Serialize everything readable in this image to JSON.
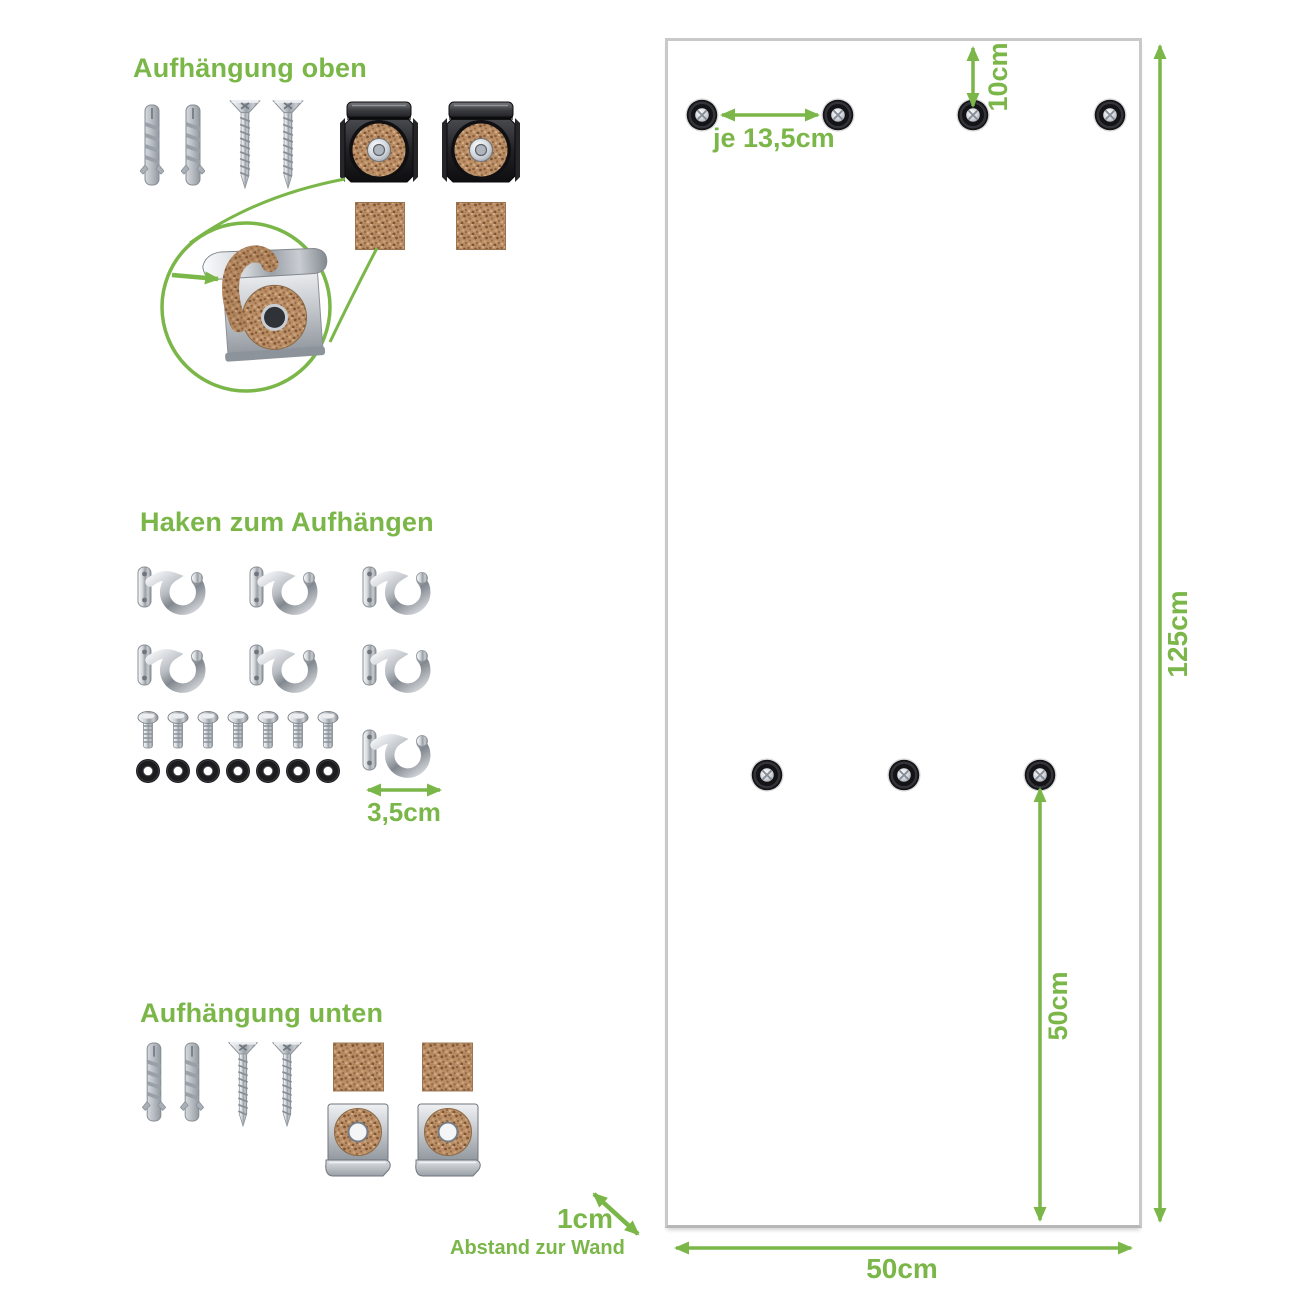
{
  "colors": {
    "green": "#7ab648",
    "cork": "#b98e66",
    "panel_border": "#c9c9c9"
  },
  "sections": {
    "top": {
      "title": "Aufhängung oben"
    },
    "hooks": {
      "title": "Haken zum Aufhängen",
      "hook_spacing_label": "3,5cm"
    },
    "bottom": {
      "title": "Aufhängung unten"
    }
  },
  "hardware_counts": {
    "top": {
      "wall_plugs": 2,
      "screws": 2,
      "mounting_clips": 2,
      "cork_pads": 2
    },
    "hooks": {
      "cup_hooks": 7,
      "bolts": 7,
      "washers": 7
    },
    "bottom": {
      "wall_plugs": 2,
      "screws": 2,
      "cork_pads": 2,
      "mounting_clips": 2
    }
  },
  "panel": {
    "top_holes": 4,
    "middle_holes": 3,
    "hole_spacing_label": "je 13,5cm",
    "top_offset_label": "10cm",
    "height_label": "125cm",
    "bottom_section_label": "50cm",
    "width_label": "50cm",
    "wall_distance_label": "1cm",
    "wall_distance_caption": "Abstand zur Wand"
  }
}
